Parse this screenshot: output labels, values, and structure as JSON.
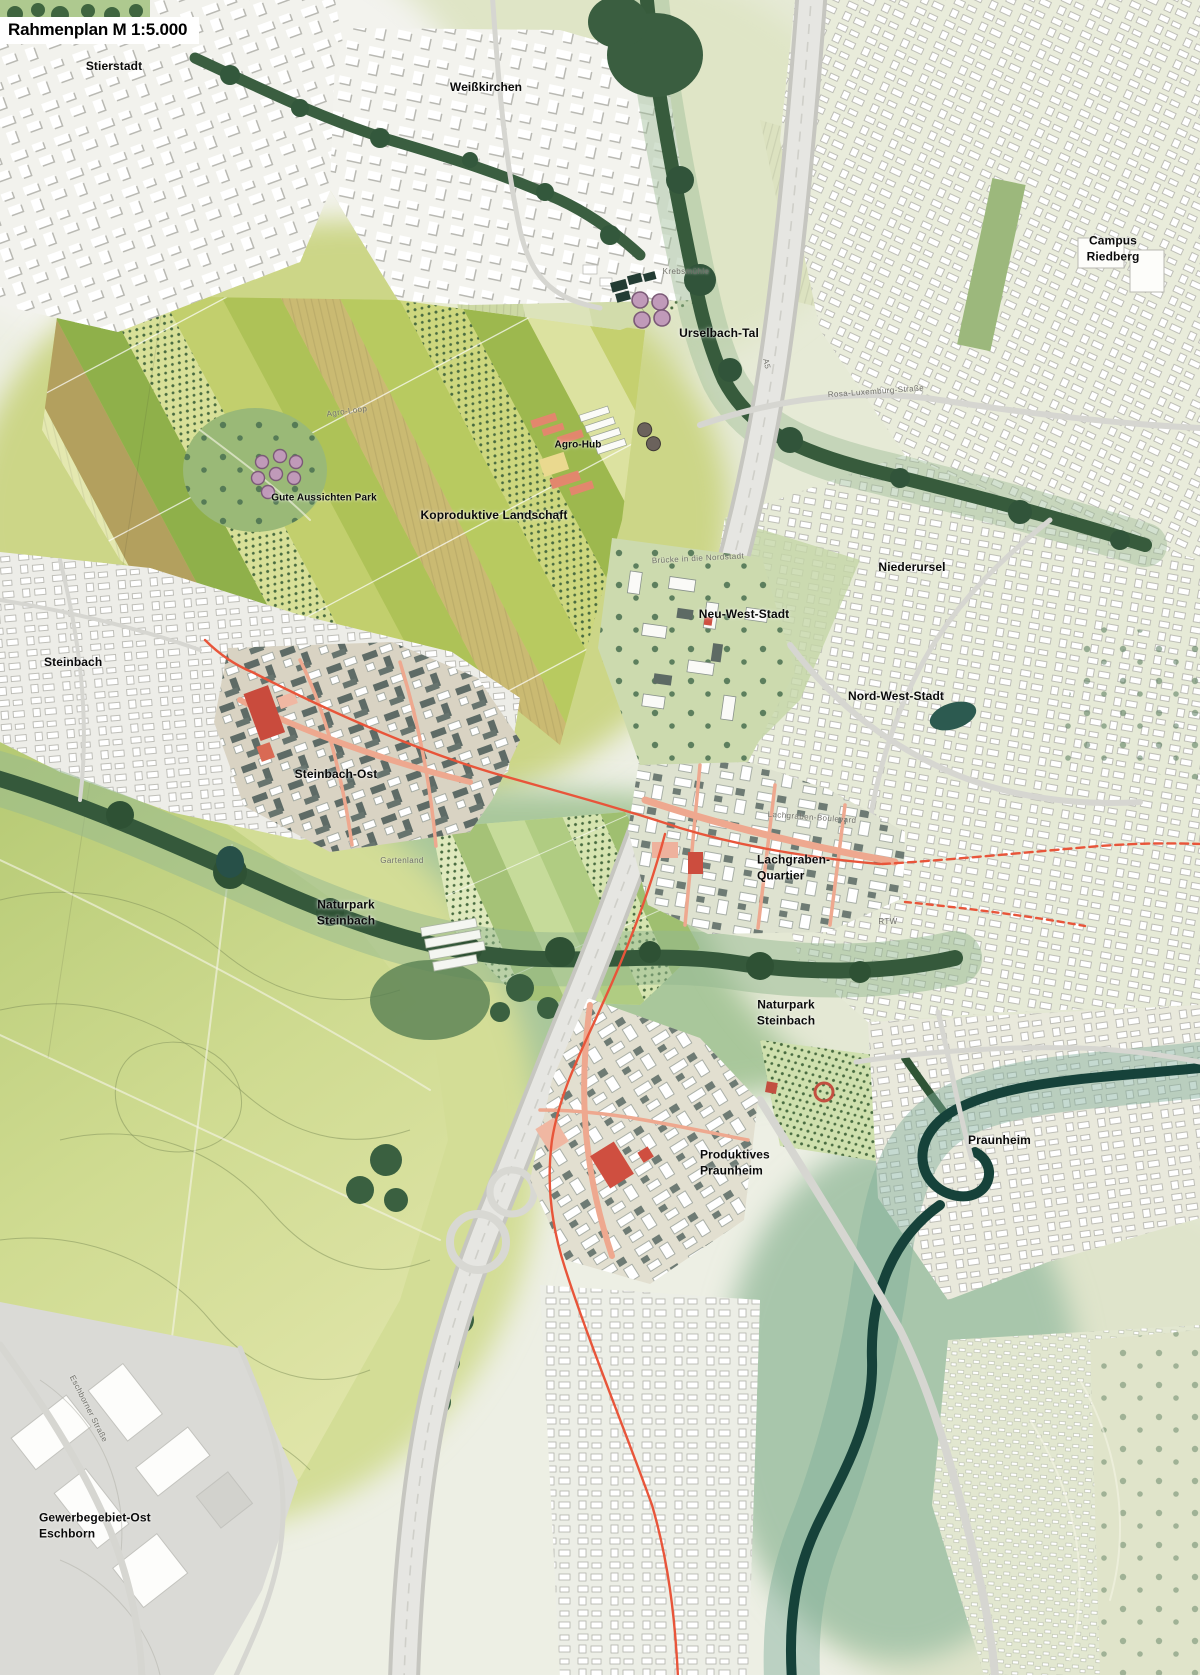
{
  "title": {
    "text": "Rahmenplan M 1:5.000"
  },
  "map": {
    "scale": "1:5.000",
    "palette": {
      "accent_route": "#e8553a",
      "street_salmon": "#eea88f",
      "landmark_red": "#cf4f40",
      "woodland_green": "#35593b",
      "river_teal": "#16423a",
      "field_yellow_green": "#c7d272",
      "meadow_green": "#cfdb91",
      "urban_white": "#ffffff",
      "new_quarter_dark": "#5e6b66",
      "label_black": "#0a0a0a",
      "label_gray": "#6f6f68",
      "title_bg": "#ffffff"
    },
    "labels": [
      {
        "id": "stierstadt",
        "text": "Stierstadt",
        "x": 114,
        "y": 67,
        "kind": "major",
        "size": 12
      },
      {
        "id": "weisskirchen",
        "text": "Weißkirchen",
        "x": 486,
        "y": 88,
        "kind": "major",
        "size": 12
      },
      {
        "id": "campus-riedberg",
        "text": "Campus Riedberg",
        "x": 1113,
        "y": 249,
        "kind": "major",
        "size": 12
      },
      {
        "id": "urselbach-tal",
        "text": "Urselbach-Tal",
        "x": 719,
        "y": 334,
        "kind": "major",
        "size": 12
      },
      {
        "id": "agro-hub",
        "text": "Agro-Hub",
        "x": 578,
        "y": 445,
        "kind": "major",
        "size": 10
      },
      {
        "id": "gute-aussichten-park",
        "text": "Gute Aussichten Park",
        "x": 324,
        "y": 498,
        "kind": "major",
        "size": 10
      },
      {
        "id": "koproduktive-landschaft",
        "text": "Koproduktive Landschaft",
        "x": 494,
        "y": 516,
        "kind": "major",
        "size": 12
      },
      {
        "id": "niederursel",
        "text": "Niederursel",
        "x": 912,
        "y": 568,
        "kind": "major",
        "size": 12
      },
      {
        "id": "neu-west-stadt",
        "text": "Neu-West-Stadt",
        "x": 744,
        "y": 615,
        "kind": "major",
        "size": 12
      },
      {
        "id": "nord-west-stadt",
        "text": "Nord-West-Stadt",
        "x": 896,
        "y": 697,
        "kind": "major",
        "size": 12
      },
      {
        "id": "steinbach",
        "text": "Steinbach",
        "x": 44,
        "y": 663,
        "kind": "major",
        "size": 12,
        "anchor": "left",
        "align": "left"
      },
      {
        "id": "steinbach-ost",
        "text": "Steinbach-Ost",
        "x": 336,
        "y": 775,
        "kind": "major",
        "size": 12
      },
      {
        "id": "lachgraben-quartier",
        "text": "Lachgraben-\nQuartier",
        "x": 757,
        "y": 868,
        "kind": "major",
        "size": 12,
        "anchor": "left",
        "align": "left"
      },
      {
        "id": "naturpark-steinbach-west",
        "text": "Naturpark\nSteinbach",
        "x": 346,
        "y": 913,
        "kind": "major",
        "size": 12
      },
      {
        "id": "naturpark-steinbach-ost",
        "text": "Naturpark\nSteinbach",
        "x": 786,
        "y": 1013,
        "kind": "major",
        "size": 12
      },
      {
        "id": "produktives-praunheim",
        "text": "Produktives\nPraunheim",
        "x": 700,
        "y": 1163,
        "kind": "major",
        "size": 12,
        "anchor": "left",
        "align": "left"
      },
      {
        "id": "praunheim",
        "text": "Praunheim",
        "x": 968,
        "y": 1141,
        "kind": "major",
        "size": 12,
        "anchor": "left"
      },
      {
        "id": "gewerbegebiet-ost-eschborn",
        "text": "Gewerbegebiet-Ost\nEschborn",
        "x": 39,
        "y": 1526,
        "kind": "major",
        "size": 12,
        "anchor": "left",
        "align": "left"
      },
      {
        "id": "krebsmuehle",
        "text": "Krebsmühle",
        "x": 686,
        "y": 272,
        "kind": "minor",
        "size": 8
      },
      {
        "id": "agro-loop",
        "text": "Agro-Loop",
        "x": 347,
        "y": 412,
        "kind": "minor",
        "size": 8,
        "rot": -8
      },
      {
        "id": "rosa-luxemburg-strasse",
        "text": "Rosa-Luxemburg-Straße",
        "x": 876,
        "y": 392,
        "kind": "minor",
        "size": 8,
        "rot": -4
      },
      {
        "id": "a5",
        "text": "A5",
        "x": 766,
        "y": 364,
        "kind": "minor",
        "size": 8,
        "rot": 78
      },
      {
        "id": "bruecke-in-die-nordstadt",
        "text": "Brücke in die Nordstadt",
        "x": 698,
        "y": 559,
        "kind": "minor",
        "size": 8,
        "rot": -3
      },
      {
        "id": "gartenland",
        "text": "Gartenland",
        "x": 402,
        "y": 861,
        "kind": "minor",
        "size": 8
      },
      {
        "id": "rtw",
        "text": "RTW",
        "x": 888,
        "y": 922,
        "kind": "minor",
        "size": 8
      },
      {
        "id": "eschborner-strasse",
        "text": "Eschborner Straße",
        "x": 88,
        "y": 1409,
        "kind": "minor",
        "size": 8,
        "rot": 63
      },
      {
        "id": "lachgraben-boulevard",
        "text": "Lachgraben-Boulevard",
        "x": 812,
        "y": 818,
        "kind": "minor",
        "size": 8,
        "rot": 4
      }
    ]
  }
}
